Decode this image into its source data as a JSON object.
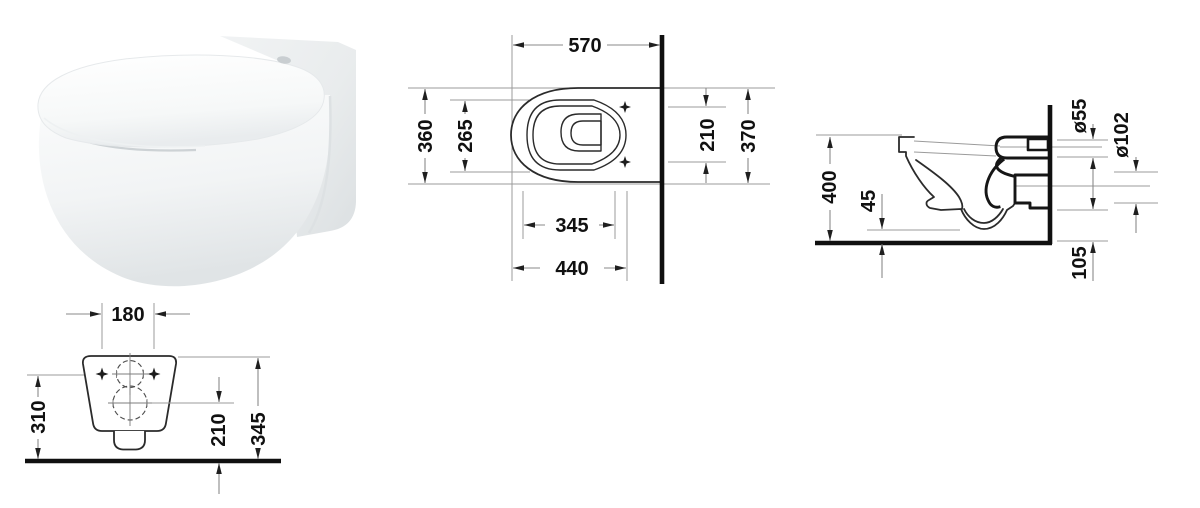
{
  "background": "#ffffff",
  "colors": {
    "object_line": "#2b2b2b",
    "heavy_line": "#161616",
    "wall_floor_line": "#101010",
    "dimension_line": "#8a8a8a",
    "label_text": "#111111"
  },
  "product_render": {
    "alt": "Wall-hung toilet with closed seat, three-quarter render"
  },
  "plan_view": {
    "dims": [
      "570",
      "360",
      "265",
      "345",
      "440",
      "210",
      "370"
    ]
  },
  "side_view": {
    "dims": [
      "400",
      "45",
      "ø55",
      "ø102",
      "105"
    ]
  },
  "rear_view": {
    "dims": [
      "180",
      "310",
      "210",
      "345"
    ]
  }
}
